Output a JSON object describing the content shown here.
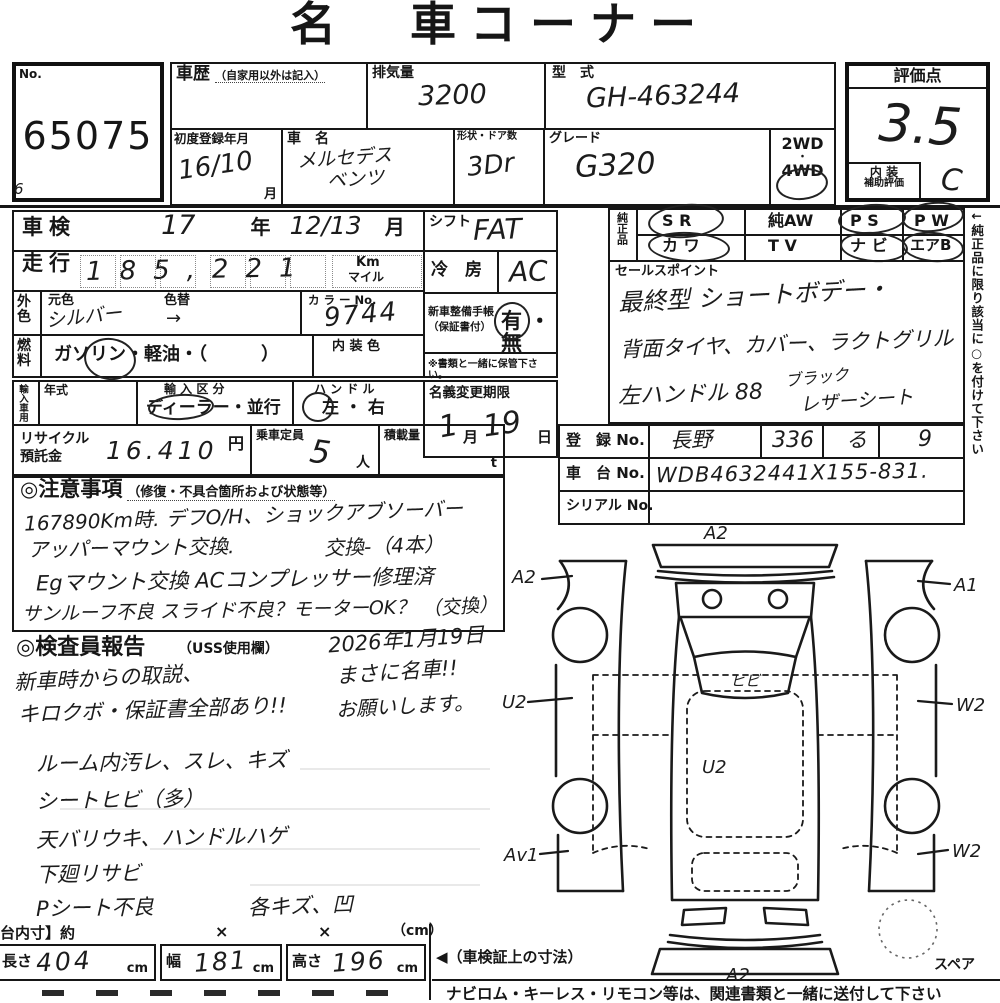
{
  "title": "名　車コーナー",
  "no_box": {
    "label": "No.",
    "value": "65075",
    "corner_mark": "6"
  },
  "top": {
    "history_label": "車歴",
    "history_note": "（自家用以外は記入）",
    "displacement_label": "排気量",
    "displacement_value": "3200",
    "model_label": "型　式",
    "model_value": "GH-463244",
    "first_reg_label": "初度登録年月",
    "first_reg_value": "16/10",
    "first_reg_unit": "月",
    "name_label": "車　名",
    "name_value1": "メルセデス",
    "name_value2": "ベンツ",
    "doors_label": "形状・ドア数",
    "doors_value": "3Dr",
    "grade_label": "グレード",
    "grade_value": "G320",
    "wd2": "2WD",
    "wd_dot": "・",
    "wd4": "4WD"
  },
  "score": {
    "label": "評価点",
    "value": "3.5",
    "interior_label1": "内 装",
    "interior_label2": "補助評価",
    "interior_value": "C"
  },
  "left": {
    "shaken_label": "車検",
    "shaken_year": "17",
    "shaken_year_unit": "年",
    "shaken_month": "12/13",
    "shaken_month_unit": "月",
    "mileage_label": "走行",
    "mileage_value": "185,221",
    "mileage_unit1": "Km",
    "mileage_unit2": "マイル",
    "ext_color_label": "外色",
    "orig_color_label": "元色",
    "recolor_label": "色替",
    "orig_color_value": "シルバー",
    "recolor_value": "→",
    "color_no_label": "カ ラ ー No.",
    "color_no_value": "9744",
    "fuel_label": "燃料",
    "fuel_options": "ガソリン・軽油・（　　　）",
    "int_color_label": "内 装 色",
    "import_label": "輸入車用",
    "import_year_label": "年式",
    "import_class_label": "輸 入 区 分",
    "import_class_value": "ディーラー・並行",
    "handle_label": "ハ ン ド ル",
    "handle_value": "左 ・ 右"
  },
  "mid": {
    "shift_label": "シフト",
    "shift_value": "FAT",
    "ac_label": "冷　房",
    "ac_value": "AC",
    "book_label1": "新車整備手帳",
    "book_label2": "（保証書付）",
    "book_value": "有 ・ 無",
    "keep_note": "※書類と一緒に保管下さい。",
    "transfer_label": "名義変更期限",
    "transfer_month": "1",
    "transfer_month_unit": "月",
    "transfer_day": "19",
    "transfer_day_unit": "日"
  },
  "genuine": {
    "label": "純正品",
    "items": [
      "S R",
      "純AW",
      "P S",
      "P W",
      "カ ワ",
      "T V",
      "ナ ビ",
      "エアB"
    ],
    "side_note": "←純正品に限り該当に○を付けて下さい"
  },
  "sales": {
    "label": "セールスポイント",
    "line1": "最終型 ショートボデー・",
    "line2": "背面タイヤ、カバー、ラクトグリル",
    "line3a": "左ハンドル 88",
    "line3b": "ブラック",
    "line3c": "レザーシート"
  },
  "reg": {
    "reg_label": "登　録 No.",
    "reg_area": "長野",
    "reg_number": "336",
    "reg_kana": "る",
    "reg_digit": "9",
    "chassis_label": "車　台 No.",
    "chassis_value": "WDB4632441X155-831.",
    "serial_label": "シリアル No."
  },
  "recycle": {
    "label1": "リサイクル",
    "label2": "預託金",
    "value": "16.410",
    "unit": "円",
    "capacity_label": "乗車定員",
    "capacity_value": "5",
    "capacity_unit": "人",
    "load_label": "積載量",
    "load_unit": "t"
  },
  "caution": {
    "heading": "◎注意事項",
    "heading_note": "（修復・不具合箇所および状態等）",
    "line1": "167890Km時. デフO/H、ショックアブソーバー",
    "line2a": "アッパーマウント交換.",
    "line2b": "交換-（4本）",
    "line3": "Egマウント交換 ACコンプレッサー修理済",
    "line4a": "サンルーフ不良 スライド不良？モーターOK？",
    "line4b": "（交換）"
  },
  "inspector": {
    "heading": "◎検査員報告",
    "heading_note": "（USS使用欄）",
    "date": "2026年1月19日",
    "note1": "新車時からの取説、",
    "note2": "キロクボ・保証書全部あり!!",
    "note3": "まさに名車!!",
    "note4": "お願いします。"
  },
  "condition": {
    "lines": [
      "ルーム内汚レ、スレ、キズ",
      "シートヒビ（多）",
      "天バリウキ、ハンドルハゲ",
      "下廻リサビ",
      "Pシート不良"
    ],
    "extra": "各キズ、凹"
  },
  "bed": {
    "label": "台内寸】約",
    "x1": "×",
    "x2": "×",
    "unit": "（cm）"
  },
  "dims": {
    "length_label": "長さ",
    "length_value": "404",
    "length_unit": "cm",
    "width_label": "幅",
    "width_value": "181",
    "width_unit": "cm",
    "height_label": "高さ",
    "height_value": "196",
    "height_unit": "cm",
    "ref_note": "◀（車検証上の寸法）",
    "spare_label": "スペア"
  },
  "footer": {
    "note": "ナビロム・キーレス・リモコン等は、関連書類と一緒に送付して下さい"
  },
  "diagram": {
    "labels": {
      "front": "A2",
      "left_front": "A2",
      "right_front": "A1",
      "left_mid": "U2",
      "right_mid": "W2",
      "roof": "U2",
      "left_rear": "Av1",
      "right_rear": "W2",
      "rear": "A2",
      "windshield": "ヒビ"
    }
  }
}
